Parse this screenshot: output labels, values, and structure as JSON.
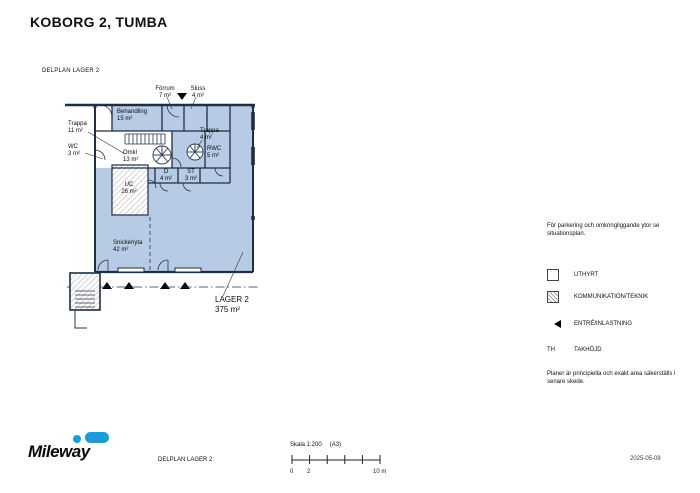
{
  "page": {
    "title": "KOBORG 2, TUMBA",
    "plan_label": "DELPLAN LAGER 2"
  },
  "colors": {
    "uthyrt_fill": "#b7cbe5",
    "wall": "#1e2e45",
    "accent_blue": "#1b9cd9"
  },
  "plan": {
    "rooms": [
      {
        "name": "forrum",
        "label": "Förrum",
        "area": "7 m²"
      },
      {
        "name": "sluss",
        "label": "Sluss",
        "area": "4 m²"
      },
      {
        "name": "behandling",
        "label": "Behandling",
        "area": "15 m²"
      },
      {
        "name": "trappa-1",
        "label": "Trappa",
        "area": "11 m²"
      },
      {
        "name": "wc",
        "label": "WC",
        "area": "3 m²"
      },
      {
        "name": "omkl",
        "label": "Omkl",
        "area": "13 m²"
      },
      {
        "name": "trappa-2",
        "label": "Trappa",
        "area": "4 m²"
      },
      {
        "name": "rwc",
        "label": "RWC",
        "area": "5 m²"
      },
      {
        "name": "d",
        "label": "D",
        "area": "4 m²"
      },
      {
        "name": "st",
        "label": "ST",
        "area": "3 m²"
      },
      {
        "name": "uc",
        "label": "UC",
        "area": "26 m²"
      },
      {
        "name": "snickeriyta",
        "label": "Snickeriyta",
        "area": "42 m²"
      }
    ],
    "main_space": {
      "label": "LAGER 2",
      "area": "375 m²"
    }
  },
  "notes": {
    "parking": "För parkering och omkringliggande ytor se situationsplan.",
    "disclaimer": "Planer är principiella och exakt area säkerställs i senare skede."
  },
  "legend": [
    {
      "label": "UTHYRT"
    },
    {
      "label": "KOMMUNIKATION/TEKNIK"
    },
    {
      "label": "ENTRÉ/INLASTNING"
    },
    {
      "label": "TAKHÖJD",
      "swatch_text": "TH"
    }
  ],
  "footer": {
    "logo": "Mileway",
    "drawing_label": "DELPLAN LAGER 2",
    "scale_label": "Skala 1:200",
    "paper": "(A3)",
    "scale_ticks": {
      "t0": "0",
      "t2": "2",
      "t10": "10 m"
    },
    "date": "2025-05-08"
  }
}
